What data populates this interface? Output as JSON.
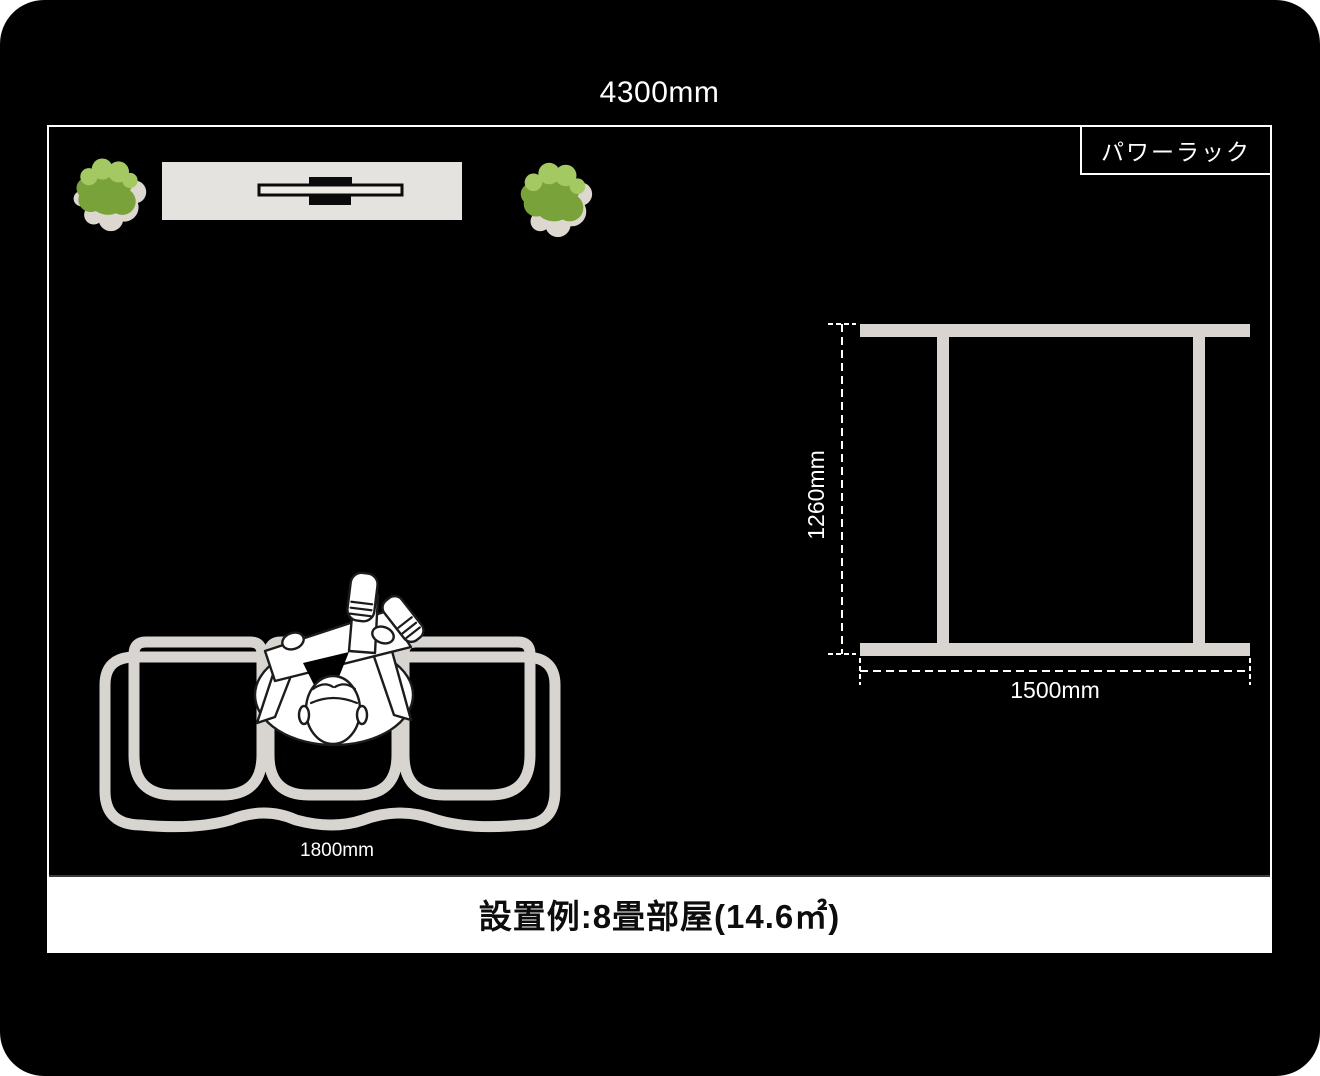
{
  "labels": {
    "room_width": "4300mm",
    "rack_name": "パワーラック",
    "rack_depth": "1260mm",
    "rack_width": "1500mm",
    "sofa_width": "1800mm",
    "caption": "設置例:8畳部屋(14.6㎡)"
  },
  "objects": {
    "room": "8畳部屋 (14.6㎡) top view floor plan",
    "power_rack": "パワーラック top view frame 1500mm × 1260mm",
    "sofa": "3-seat sofa top view, 1800mm wide, with seated person",
    "tv_stand": "TV board with flat-screen TV, top view",
    "plants": "two potted plants flanking the TV stand"
  },
  "colors": {
    "page_bg": "#ffffff",
    "canvas_bg": "#000000",
    "line_white": "#ffffff",
    "furniture_gray": "#d8d5d1",
    "tv_stand_fill": "#e5e3df",
    "tv_black": "#0b0b0b",
    "plant_green": "#7aa23b",
    "plant_green_light": "#a4c963",
    "plant_shadow": "#dcd8cf",
    "figure_white": "#ffffff",
    "figure_outline": "#1c1c1c",
    "caption_bg": "#ffffff",
    "caption_text": "#0d0d0d",
    "caption_divider": "#3b3b3b"
  }
}
